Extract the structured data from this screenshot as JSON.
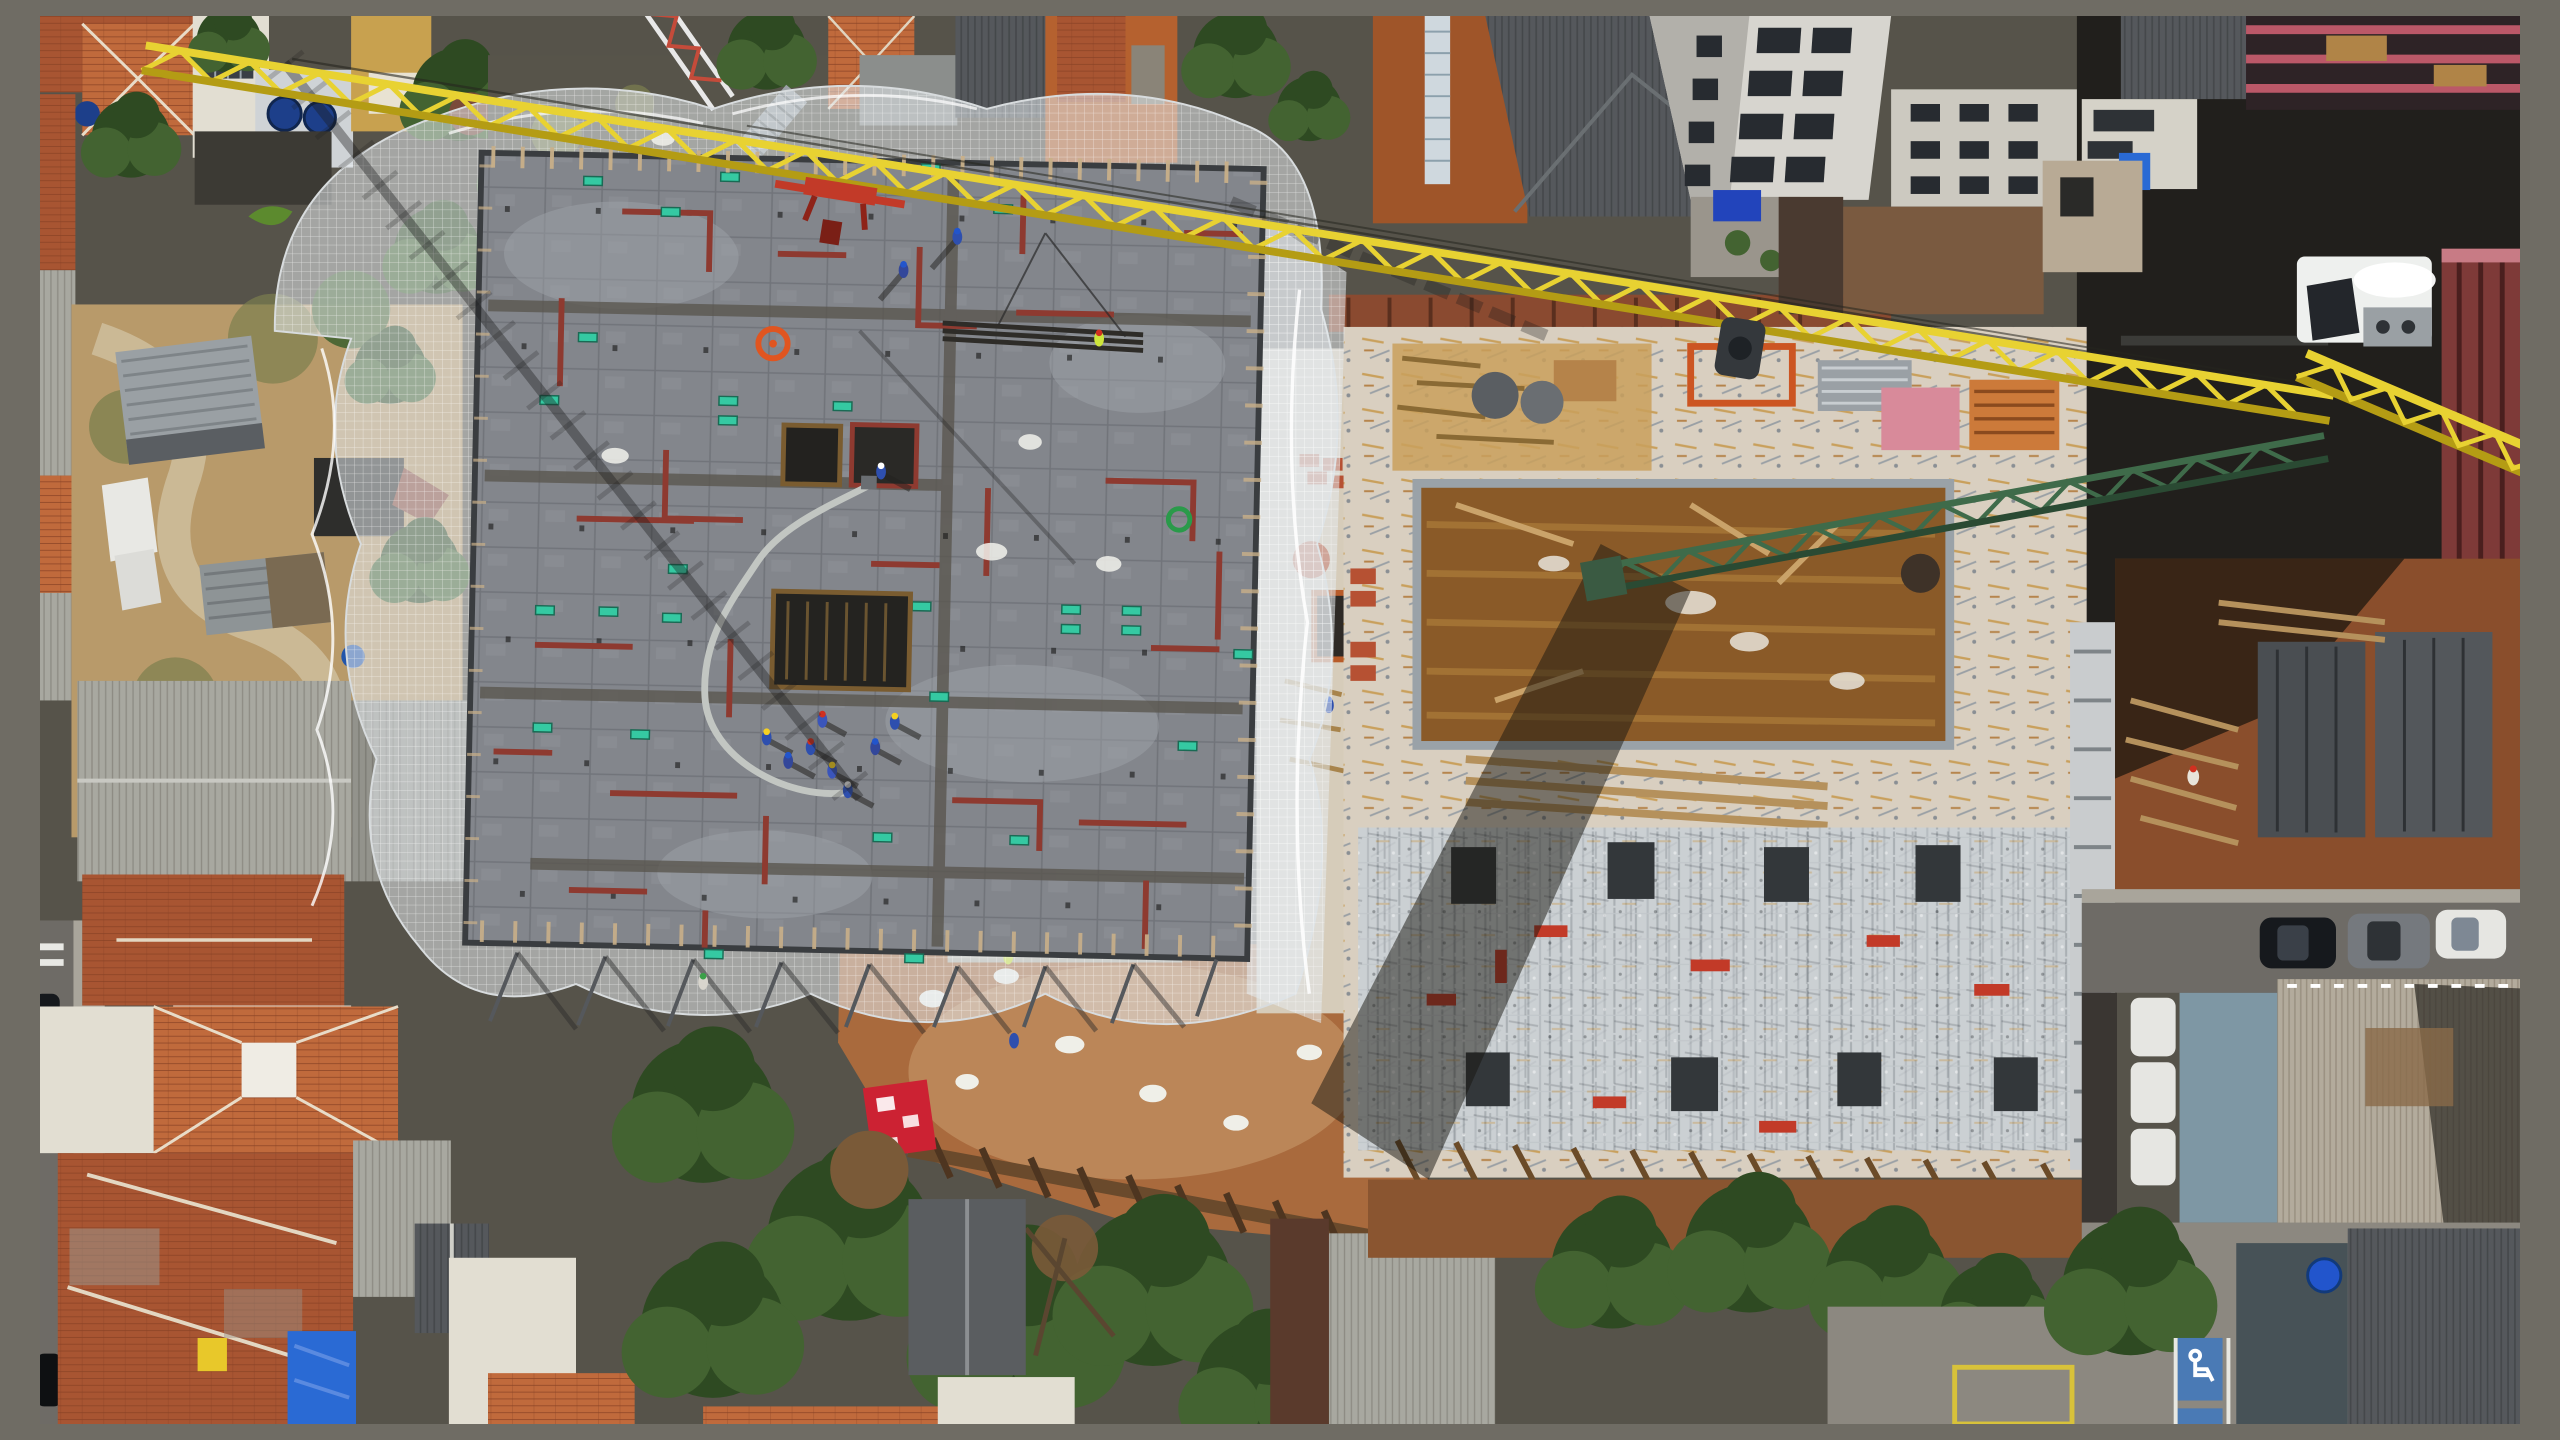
{
  "scene": {
    "title": "Top-down aerial drone photo of an urban construction site: a grey safety-netted formwork slab and a second scaffolded building slab, crossed diagonally by a yellow tower-crane jib with green counter-jib and white operator cab, surrounded by terracotta-roofed houses, trees, dirt excavation, vacant lots and streets with parked cars",
    "camera": "top-down aerial, hard midday sun with long lattice shadows",
    "accessible_parking_glyph": "wheelchair-pictogram",
    "palette": {
      "net": "#e4e8ec",
      "net_shade": "#aab0b6",
      "slab": "#83868c",
      "slab_dark": "#63666c",
      "slab_light": "#9ea2a8",
      "red_line": "#8e3a30",
      "teal": "#35c9a2",
      "yellow_crane": "#e8d232",
      "yellow_crane_dark": "#b49c14",
      "green_jib": "#3f6b4a",
      "green_jib_dark": "#2a4a33",
      "cab_white": "#eef0ee",
      "steel_red": "#c23a28",
      "roof_tile": "#a85532",
      "roof_tile_light": "#c06a3c",
      "roof_tile_dark": "#8a4326",
      "roof_grey": "#a8a8a0",
      "roof_grey_dark": "#55585c",
      "warehouse_roof": "#b3ab9c",
      "white_wall": "#e2ded2",
      "brick_orange": "#b5612f",
      "window_dark": "#272b30",
      "tree_dark": "#2e4a22",
      "tree_mid": "#436331",
      "tree_brown": "#7a5a38",
      "grass": "#7c7f4e",
      "dirt": "#a96a3d",
      "dirt_light": "#c89a6a",
      "dirt_dark": "#8a4e2c",
      "cream": "#d9cfc0",
      "plywood": "#8a5a28",
      "plywood_light": "#a87838",
      "scaffold_bg": "#cbd0d3",
      "scaffold_line": "#878c91",
      "dark_box": "#33373a",
      "asphalt": "#6e6b66",
      "sidewalk": "#a9a59b",
      "shadow": "#17150f",
      "blue_tank": "#1d3f8a",
      "blue_tarp": "#2a6ad4",
      "red_banner": "#cc2233",
      "hivis": "#cde53a",
      "pink_mesh": "#bb5868",
      "blue_parking": "#4a7ab5",
      "ground_dark": "#56534a",
      "timber": "#c9b089",
      "car_dark": "#16191d",
      "car_grey": "#75797e",
      "car_white": "#e6e6e2"
    },
    "objects": [
      {
        "name": "tower-crane",
        "parts": [
          "yellow-lattice-jib",
          "green-counter-jib",
          "white-operator-cab",
          "red-trolley-spreader",
          "dark-hoist-block",
          "pendant-cables"
        ],
        "jib_color_ref": "yellow_crane",
        "counter_jib_color_ref": "green_jib"
      },
      {
        "name": "netted-slab-building",
        "status": "formwork-and-rebar-deck",
        "features": [
          "grey perimeter safety netting with scalloped skirt",
          "panelled grey deck",
          "dark-red layout lines",
          "teal rebar markers",
          "orange hose coil",
          "green hose coil",
          "two dark floor openings with timber shoring",
          "grey concrete pump hose"
        ]
      },
      {
        "name": "construction-workers",
        "count_visible": 15,
        "ppe": [
          "blue overalls",
          "yellow helmet",
          "blue helmet",
          "red helmet",
          "white helmet",
          "hi-vis vest"
        ]
      },
      {
        "name": "second-building-slab",
        "status": "shoring-and-scaffolding",
        "features": [
          "cream concrete deck",
          "brown plywood formwork bays",
          "lumber piles",
          "brick piles",
          "dark column form boxes",
          "red formwork frames",
          "raker shores into dirt"
        ]
      },
      {
        "name": "crane-shadows",
        "features": [
          "lattice jib shadow across netted slab",
          "wide mast shadow across second slab"
        ]
      },
      {
        "name": "houses",
        "roofs": [
          "terracotta tile",
          "fiber-cement grey",
          "corrugated metal"
        ],
        "details": [
          "inner courtyard",
          "green striped awning",
          "blue tarp patch",
          "rooftop water tanks"
        ]
      },
      {
        "name": "highrise-apartment-tower",
        "style": "white facade, dark window grid, oblique view"
      },
      {
        "name": "warehouse-roofs",
        "color_ref": "warehouse_roof"
      },
      {
        "name": "pink-mesh-wrapped-building",
        "color_ref": "pink_mesh"
      },
      {
        "name": "excavation-areas",
        "features": [
          "orange-brown soil",
          "timber lagging wall",
          "white sacks",
          "red banner with white logo",
          "formwork panels"
        ]
      },
      {
        "name": "trees",
        "colors": [
          "dark green",
          "mid green",
          "dry brown patches"
        ]
      },
      {
        "name": "streets",
        "features": [
          "left vertical street with crosswalk",
          "right street with parked cars",
          "accessible parking stalls"
        ]
      },
      {
        "name": "parked-cars",
        "count_visible": 6,
        "colors": [
          "black",
          "grey",
          "white"
        ]
      },
      {
        "name": "accessible-parking-stall",
        "icon": "wheelchair-pictogram",
        "color_ref": "blue_parking"
      },
      {
        "name": "small-lattice-tower",
        "colors": [
          "white",
          "red"
        ]
      },
      {
        "name": "vacant-lot",
        "features": [
          "grey container sheds",
          "white panels",
          "grass",
          "dirt path",
          "blue umbrella"
        ]
      }
    ]
  }
}
